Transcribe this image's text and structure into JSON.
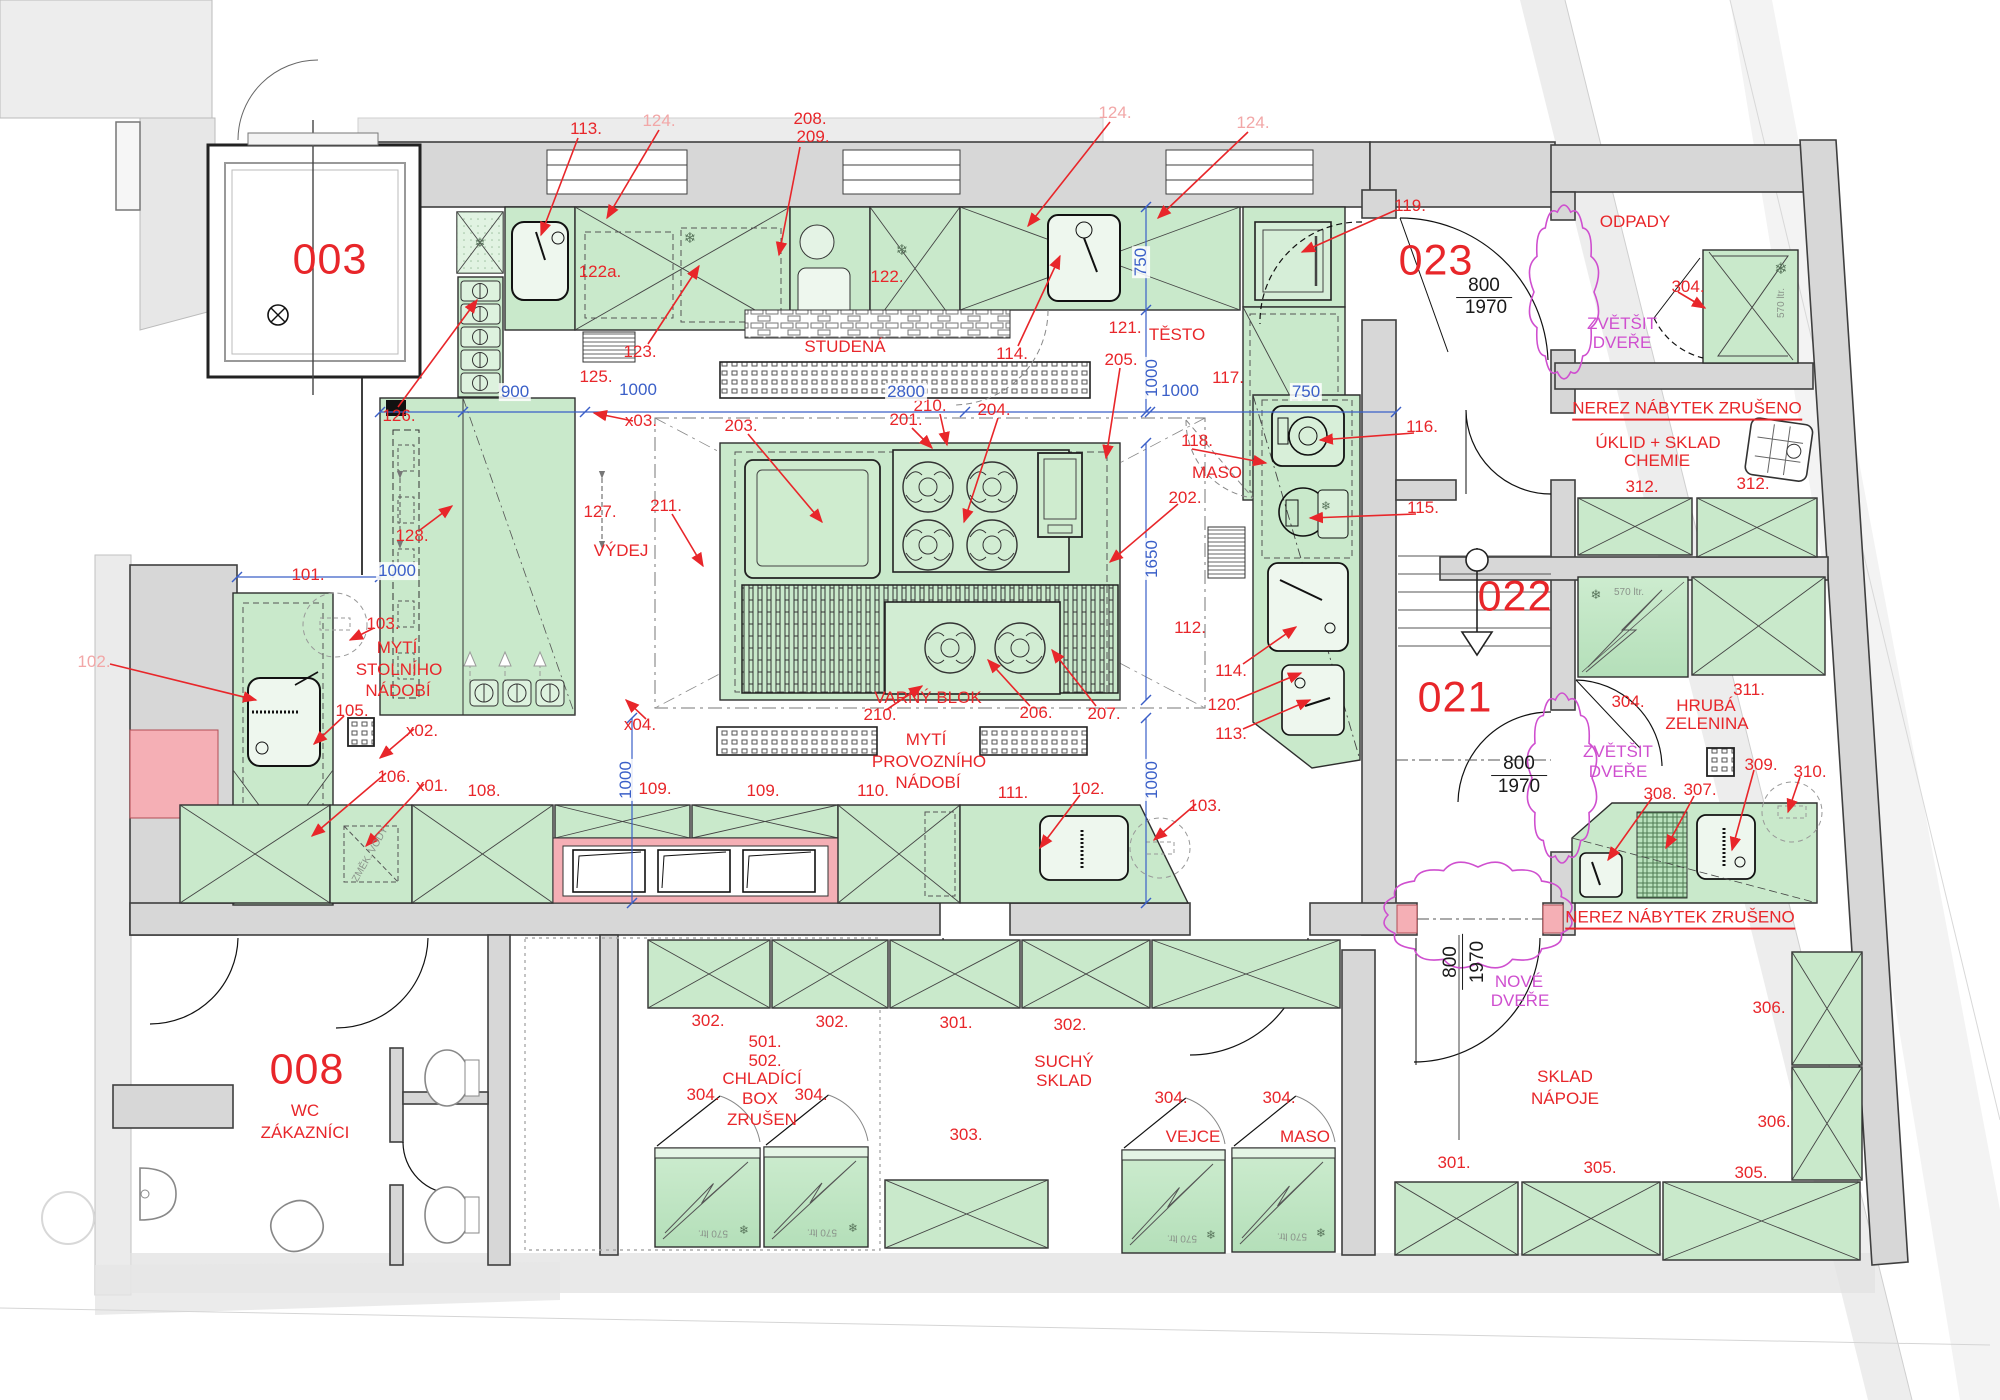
{
  "canvas": {
    "width": 2000,
    "height": 1400
  },
  "palette": {
    "wall_gray": "#d7d7d7",
    "wall_stroke": "#3f3f3f",
    "equipment_green": "#c9e9cb",
    "equipment_green_light": "#ddf2de",
    "annotation_red": "#e8262a",
    "annotation_faded": "#f2a7a7",
    "dimension_blue": "#3a5fc8",
    "revision_magenta": "#cf4fcf",
    "revision_pink": "#f5afb5",
    "text_black": "#1a1a1a",
    "note_gray": "#8a938a"
  },
  "icons": {
    "snowflake": "❄",
    "lamp_cross": "⊗"
  },
  "annotations": {
    "room_numbers": [
      {
        "t": "003",
        "x": 330,
        "y": 260
      },
      {
        "t": "023",
        "x": 1436,
        "y": 261
      },
      {
        "t": "022",
        "x": 1515,
        "y": 597
      },
      {
        "t": "021",
        "x": 1455,
        "y": 698
      },
      {
        "t": "008",
        "x": 307,
        "y": 1070
      }
    ],
    "labels": [
      {
        "t": "113.",
        "x": 586,
        "y": 129
      },
      {
        "t": "208.",
        "x": 810,
        "y": 119
      },
      {
        "t": "209.",
        "x": 813,
        "y": 137
      },
      {
        "t": "119.",
        "x": 1410,
        "y": 206
      },
      {
        "t": "122a.",
        "x": 600,
        "y": 272
      },
      {
        "t": "122.",
        "x": 887,
        "y": 277
      },
      {
        "t": "STUDENÁ",
        "x": 845,
        "y": 347
      },
      {
        "t": "123.",
        "x": 640,
        "y": 352
      },
      {
        "t": "125.",
        "x": 596,
        "y": 377
      },
      {
        "t": "126.",
        "x": 399,
        "y": 416
      },
      {
        "t": "121.",
        "x": 1125,
        "y": 328
      },
      {
        "t": "TĚSTO",
        "x": 1177,
        "y": 335
      },
      {
        "t": "114.",
        "x": 1012,
        "y": 354
      },
      {
        "t": "205.",
        "x": 1121,
        "y": 360
      },
      {
        "t": "117.",
        "x": 1228,
        "y": 378
      },
      {
        "t": "x03.",
        "x": 641,
        "y": 421
      },
      {
        "t": "203.",
        "x": 741,
        "y": 426
      },
      {
        "t": "210.",
        "x": 930,
        "y": 406
      },
      {
        "t": "201.",
        "x": 906,
        "y": 420
      },
      {
        "t": "204.",
        "x": 994,
        "y": 410
      },
      {
        "t": "211.",
        "x": 666,
        "y": 506
      },
      {
        "t": "127.",
        "x": 600,
        "y": 512
      },
      {
        "t": "VÝDEJ",
        "x": 621,
        "y": 551
      },
      {
        "t": "128.",
        "x": 412,
        "y": 536
      },
      {
        "t": "118.",
        "x": 1197,
        "y": 441
      },
      {
        "t": "MASO",
        "x": 1217,
        "y": 473
      },
      {
        "t": "202.",
        "x": 1185,
        "y": 498
      },
      {
        "t": "116.",
        "x": 1422,
        "y": 427
      },
      {
        "t": "115.",
        "x": 1423,
        "y": 508
      },
      {
        "t": "112.",
        "x": 1190,
        "y": 628
      },
      {
        "t": "114.",
        "x": 1231,
        "y": 671
      },
      {
        "t": "120.",
        "x": 1224,
        "y": 705
      },
      {
        "t": "113.",
        "x": 1231,
        "y": 734
      },
      {
        "t": "VARNÝ BLOK",
        "x": 928,
        "y": 698
      },
      {
        "t": "210.",
        "x": 880,
        "y": 715
      },
      {
        "t": "206.",
        "x": 1036,
        "y": 713
      },
      {
        "t": "207.",
        "x": 1104,
        "y": 714
      },
      {
        "t": "x04.",
        "x": 640,
        "y": 725
      },
      {
        "t": "MYTÍ",
        "x": 926,
        "y": 740
      },
      {
        "t": "PROVOZNÍHO",
        "x": 929,
        "y": 762
      },
      {
        "t": "NÁDOBÍ",
        "x": 928,
        "y": 783
      },
      {
        "t": "101.",
        "x": 308,
        "y": 575
      },
      {
        "t": "103.",
        "x": 383,
        "y": 624
      },
      {
        "t": "MYTÍ",
        "x": 397,
        "y": 648
      },
      {
        "t": "STOLNÍHO",
        "x": 399,
        "y": 670
      },
      {
        "t": "NÁDOBÍ",
        "x": 398,
        "y": 691
      },
      {
        "t": "105.",
        "x": 352,
        "y": 711
      },
      {
        "t": "x02.",
        "x": 422,
        "y": 731
      },
      {
        "t": "106.",
        "x": 394,
        "y": 777
      },
      {
        "t": "x01.",
        "x": 432,
        "y": 786
      },
      {
        "t": "108.",
        "x": 484,
        "y": 791
      },
      {
        "t": "109.",
        "x": 655,
        "y": 789
      },
      {
        "t": "109.",
        "x": 763,
        "y": 791
      },
      {
        "t": "110.",
        "x": 873,
        "y": 791
      },
      {
        "t": "111.",
        "x": 1013,
        "y": 793
      },
      {
        "t": "102.",
        "x": 1088,
        "y": 789
      },
      {
        "t": "103.",
        "x": 1205,
        "y": 806
      },
      {
        "t": "ODPADY",
        "x": 1635,
        "y": 222
      },
      {
        "t": "304.",
        "x": 1688,
        "y": 287
      },
      {
        "t": "ÚKLID + SKLAD",
        "x": 1658,
        "y": 443
      },
      {
        "t": "CHEMIE",
        "x": 1657,
        "y": 461
      },
      {
        "t": "312.",
        "x": 1642,
        "y": 487
      },
      {
        "t": "312.",
        "x": 1753,
        "y": 484
      },
      {
        "t": "311.",
        "x": 1749,
        "y": 690
      },
      {
        "t": "HRUBÁ",
        "x": 1706,
        "y": 706
      },
      {
        "t": "ZELENINA",
        "x": 1707,
        "y": 724
      },
      {
        "t": "304.",
        "x": 1628,
        "y": 702
      },
      {
        "t": "309.",
        "x": 1761,
        "y": 765
      },
      {
        "t": "310.",
        "x": 1810,
        "y": 772
      },
      {
        "t": "308.",
        "x": 1660,
        "y": 794
      },
      {
        "t": "307.",
        "x": 1700,
        "y": 790
      },
      {
        "t": "302.",
        "x": 708,
        "y": 1021
      },
      {
        "t": "302.",
        "x": 832,
        "y": 1022
      },
      {
        "t": "301.",
        "x": 956,
        "y": 1023
      },
      {
        "t": "302.",
        "x": 1070,
        "y": 1025
      },
      {
        "t": "501.",
        "x": 765,
        "y": 1042
      },
      {
        "t": "502.",
        "x": 765,
        "y": 1061
      },
      {
        "t": "CHLADÍCÍ",
        "x": 762,
        "y": 1079
      },
      {
        "t": "BOX",
        "x": 760,
        "y": 1099
      },
      {
        "t": "ZRUŠEN",
        "x": 762,
        "y": 1120
      },
      {
        "t": "304.",
        "x": 703,
        "y": 1095
      },
      {
        "t": "304.",
        "x": 811,
        "y": 1095
      },
      {
        "t": "303.",
        "x": 966,
        "y": 1135
      },
      {
        "t": "SUCHÝ",
        "x": 1064,
        "y": 1062
      },
      {
        "t": "SKLAD",
        "x": 1064,
        "y": 1081
      },
      {
        "t": "304.",
        "x": 1171,
        "y": 1098
      },
      {
        "t": "VEJCE",
        "x": 1193,
        "y": 1137
      },
      {
        "t": "304.",
        "x": 1279,
        "y": 1098
      },
      {
        "t": "MASO",
        "x": 1305,
        "y": 1137
      },
      {
        "t": "SKLAD",
        "x": 1565,
        "y": 1077
      },
      {
        "t": "NÁPOJE",
        "x": 1565,
        "y": 1099
      },
      {
        "t": "301.",
        "x": 1454,
        "y": 1163
      },
      {
        "t": "305.",
        "x": 1600,
        "y": 1168
      },
      {
        "t": "305.",
        "x": 1751,
        "y": 1173
      },
      {
        "t": "306.",
        "x": 1769,
        "y": 1008
      },
      {
        "t": "306.",
        "x": 1774,
        "y": 1122
      },
      {
        "t": "WC",
        "x": 305,
        "y": 1111
      },
      {
        "t": "ZÁKAZNÍCI",
        "x": 305,
        "y": 1133
      }
    ],
    "faded_labels": [
      {
        "t": "124.",
        "x": 659,
        "y": 121
      },
      {
        "t": "124.",
        "x": 1115,
        "y": 113
      },
      {
        "t": "124.",
        "x": 1253,
        "y": 123
      },
      {
        "t": "102.",
        "x": 94,
        "y": 662
      }
    ],
    "underlined_notes": [
      {
        "t": "NEREZ NÁBYTEK ZRUŠENO",
        "x": 1687,
        "y": 410
      },
      {
        "t": "NEREZ NÁBYTEK ZRUŠENO",
        "x": 1680,
        "y": 919
      }
    ],
    "dimensions_blue": [
      {
        "t": "900",
        "x": 515,
        "y": 392,
        "rot": 0
      },
      {
        "t": "1000",
        "x": 638,
        "y": 390,
        "rot": 0
      },
      {
        "t": "2800",
        "x": 906,
        "y": 392,
        "rot": 0
      },
      {
        "t": "1000",
        "x": 1180,
        "y": 391,
        "rot": 0
      },
      {
        "t": "750",
        "x": 1306,
        "y": 392,
        "rot": 0
      },
      {
        "t": "750",
        "x": 1141,
        "y": 262,
        "rot": -90
      },
      {
        "t": "1000",
        "x": 1152,
        "y": 378,
        "rot": -90
      },
      {
        "t": "1650",
        "x": 1152,
        "y": 559,
        "rot": -90
      },
      {
        "t": "1000",
        "x": 626,
        "y": 780,
        "rot": -90
      },
      {
        "t": "1000",
        "x": 1152,
        "y": 780,
        "rot": -90
      },
      {
        "t": "1000",
        "x": 397,
        "y": 571,
        "rot": 0
      }
    ],
    "door_dimensions_black": [
      {
        "t": "800",
        "x": 1484,
        "y": 287,
        "rot": 0,
        "u": 1
      },
      {
        "t": "1970",
        "x": 1486,
        "y": 308,
        "rot": 0,
        "u": 0
      },
      {
        "t": "800",
        "x": 1519,
        "y": 765,
        "rot": 0,
        "u": 1
      },
      {
        "t": "1970",
        "x": 1519,
        "y": 787,
        "rot": 0,
        "u": 0
      },
      {
        "t": "800",
        "x": 1452,
        "y": 962,
        "rot": -90,
        "u": 1
      },
      {
        "t": "1970",
        "x": 1478,
        "y": 962,
        "rot": -90,
        "u": 0
      }
    ],
    "revision_magenta": [
      {
        "t": "ZVĚTŠIT",
        "x": 1622,
        "y": 324
      },
      {
        "t": "DVEŘE",
        "x": 1622,
        "y": 343
      },
      {
        "t": "ZVĚTŠIT",
        "x": 1618,
        "y": 752
      },
      {
        "t": "DVEŘE",
        "x": 1618,
        "y": 772
      },
      {
        "t": "NOVÉ",
        "x": 1519,
        "y": 982
      },
      {
        "t": "DVEŘE",
        "x": 1520,
        "y": 1001
      }
    ],
    "equipment_notes_gray": [
      {
        "t": "570 ltr.",
        "x": 1782,
        "y": 303,
        "rot": -90
      },
      {
        "t": "570 ltr.",
        "x": 1629,
        "y": 593,
        "rot": 0
      },
      {
        "t": "570 ltr.",
        "x": 713,
        "y": 1232,
        "rot": 180
      },
      {
        "t": "570 ltr.",
        "x": 822,
        "y": 1231,
        "rot": 180
      },
      {
        "t": "570 ltr.",
        "x": 1182,
        "y": 1237,
        "rot": 180
      },
      {
        "t": "570 ltr.",
        "x": 1292,
        "y": 1235,
        "rot": 180
      },
      {
        "t": "ZMĚK. VODY",
        "x": 371,
        "y": 855,
        "rot": -60
      }
    ]
  }
}
